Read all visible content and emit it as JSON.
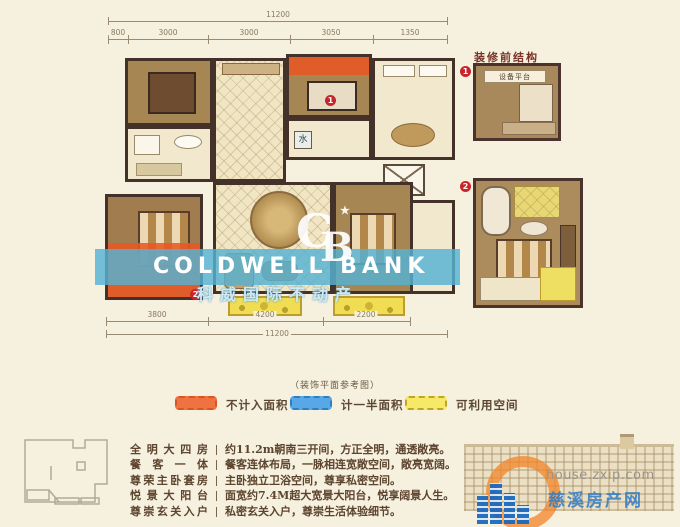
{
  "colors": {
    "background": "#f6f0df",
    "not_counted_area": "#ef7342",
    "half_counted_area": "#58a8e8",
    "usable_space": "#f6e96a",
    "watermark_band": "#54b2d4",
    "marker_red": "#c8242a"
  },
  "plan": {
    "dims_top": {
      "total": "11200",
      "segments": [
        "800",
        "3000",
        "3000",
        "3050",
        "1350"
      ]
    },
    "dims_bottom": {
      "total": "11200",
      "segments": [
        "3800",
        "4200",
        "2200"
      ]
    },
    "labels": {
      "water": "水"
    },
    "markers": {
      "m1": "1",
      "m2": "2"
    }
  },
  "pre_renovation": {
    "title": "装修前结构",
    "plan1_label": "设备平台",
    "marker1": "1",
    "marker2": "2"
  },
  "legend": {
    "caption": "（装饰平面参考图）",
    "items": [
      {
        "label": "不计入面积",
        "color": "#ef7342",
        "border": "#d85520"
      },
      {
        "label": "计一半面积",
        "color": "#58a8e8",
        "border": "#2f7fc0"
      },
      {
        "label": "可利用空间",
        "color": "#f6e96a",
        "border": "#c0a428"
      }
    ]
  },
  "features": [
    {
      "title": "全明大四房",
      "desc": "约11.2m朝南三开间，方正全明，通透敞亮。"
    },
    {
      "title": "餐客一体",
      "desc": "餐客连体布局，一脉相连宽敞空间，敞亮宽阔。"
    },
    {
      "title": "尊荣主卧套房",
      "desc": "主卧独立卫浴空间，尊享私密空间。"
    },
    {
      "title": "悦景大阳台",
      "desc": "面宽约7.4M超大宽景大阳台，悦享阔景人生。"
    },
    {
      "title": "尊崇玄关入户",
      "desc": "私密玄关入户，尊崇生活体验细节。"
    }
  ],
  "watermark_center": {
    "logo_c": "C",
    "logo_b": "B",
    "star": "★",
    "brand": "COLDWELL BANK",
    "brand_cn": "科威国际不动产"
  },
  "watermark_corner": {
    "url": "house.zxip.com",
    "site_name": "慈溪房产网"
  }
}
